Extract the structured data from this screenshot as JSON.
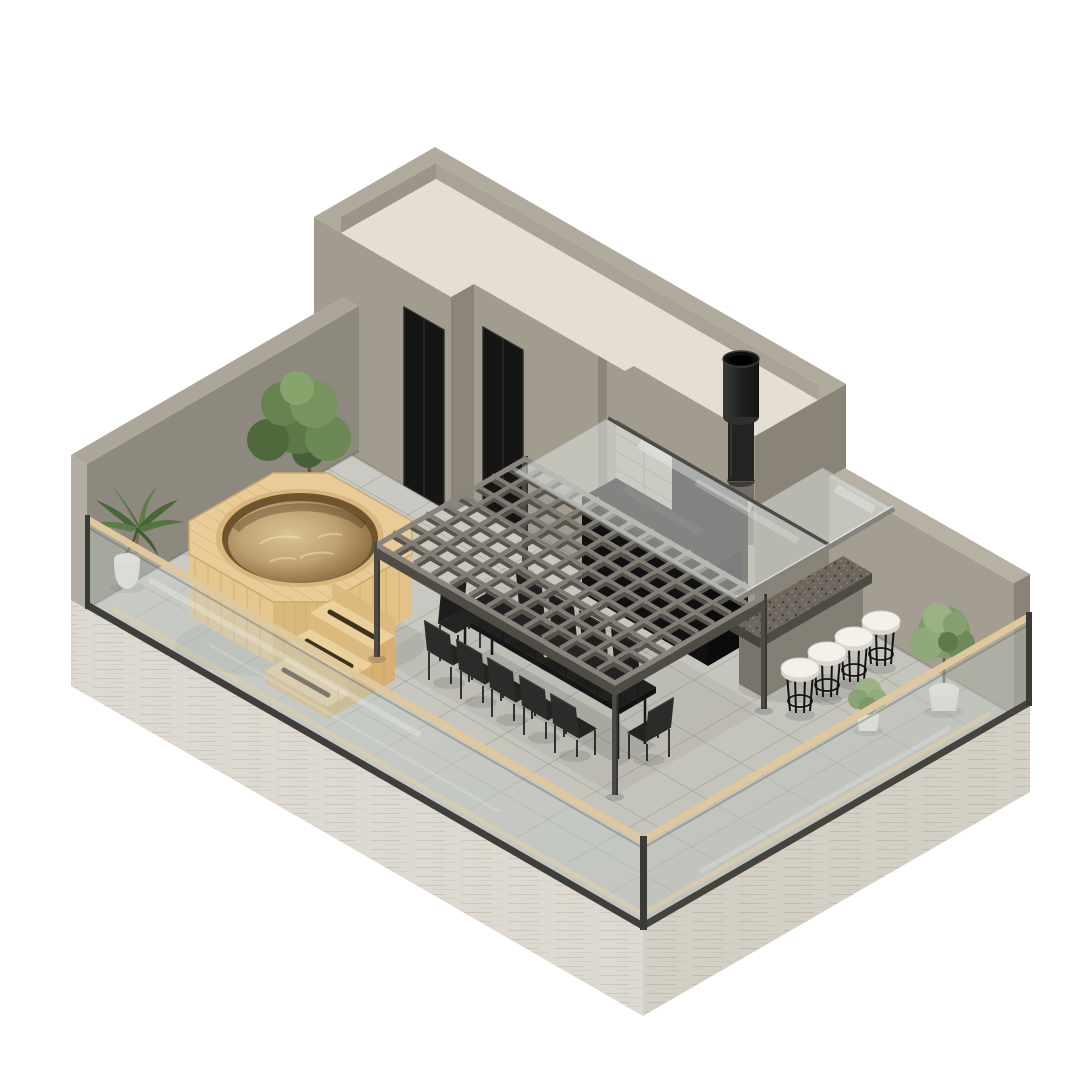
{
  "image_type": "isometric-3d-render-rooftop-terrace",
  "scene": {
    "penthouse": {
      "doors": 2,
      "roof": "flat beige deck with concrete parapet",
      "chimney_flues": 1
    },
    "hot_tub": {
      "shape": "octagonal wooden deck with round water basin",
      "stair_steps": 3,
      "step_slots": 3
    },
    "pergola": {
      "posts": 4,
      "grid_cells_x": 13,
      "grid_cells_y": 9
    },
    "dining_set": {
      "tables": 1,
      "chairs": 11,
      "tray_items": "bottles and cups"
    },
    "outdoor_kitchen": {
      "glass_canopy": 1,
      "black_counters": 1,
      "tiled_backsplash": 1
    },
    "bar": {
      "granite_counter": 1,
      "stools": 4
    },
    "plants": {
      "tree": 1,
      "palm": 1,
      "bushes": 2,
      "white_pots": 3
    },
    "railing": {
      "glass_sides": 2,
      "wood_cap": true,
      "concrete_walls": 2
    }
  },
  "palette": {
    "bg": "#ffffff",
    "travertine": "#ded9d0",
    "floor": "#cac9c3",
    "tan_strip": "#e4cda4",
    "wall_front": "#a29c8f",
    "wall_side": "#8b857a",
    "wall_right": "#8a8478",
    "wall_inner_right": "#a49e92",
    "wall_cap": "#b7b1a4",
    "leftwall_face": "#8e897f",
    "leftwall_cap": "#aca69a",
    "leftwall_end": "#b3aea3",
    "parapet_top": "#b0aa9d",
    "roof_deck": "#e5ded3",
    "roof_inner_x": "#9b9588",
    "roof_inner_y": "#a9a396",
    "door": "#151514",
    "kitchen_recess": "#161614",
    "backsplash": "#b0aca0",
    "counter_black": "#171716",
    "granite": "#6d675e",
    "granite_dark": "#4e4a44",
    "granite_end": "#47433d",
    "concrete_pier": "#847f75",
    "concrete_pier2": "#79746b",
    "stool_seat": "#f3f1ea",
    "stool_rim": "#d9d6cc",
    "black_metal": "#161616",
    "pergola_top": "#827d74",
    "pergola_side": "#56534c",
    "pergola_frame": "#8a857c",
    "pergola_frame_side": "#4f4c45",
    "post": "#4b4a45",
    "table_top": "#20201f",
    "chair": "#232322",
    "chair_dark": "#1d1d1c",
    "wood_deck": "#e8cb96",
    "wood_apron": "#e2c287",
    "wood_apron2": "#d9b87c",
    "wood_side": "#d6b072",
    "wood_steps": "#ecd09b",
    "wood_riser": "#dcba7f",
    "pool_wall": "#6e552f",
    "rail_glass": "rgba(196,204,199,0.45)",
    "rail_glass2": "rgba(190,198,193,0.42)",
    "rail_cap": "#e0c89d",
    "rail_channel": "#3f3e3a",
    "canopy_glass": "rgba(226,232,228,0.52)",
    "canopy_metal": "#83837c",
    "chimney": "#2b2b29",
    "foliage_dark": "#4e6a3c",
    "foliage_mid": "#6b8955",
    "foliage_light": "#87a46c",
    "bush_light": "#8fa97a",
    "palm": "#53743f",
    "pot": "#f0eee7"
  }
}
